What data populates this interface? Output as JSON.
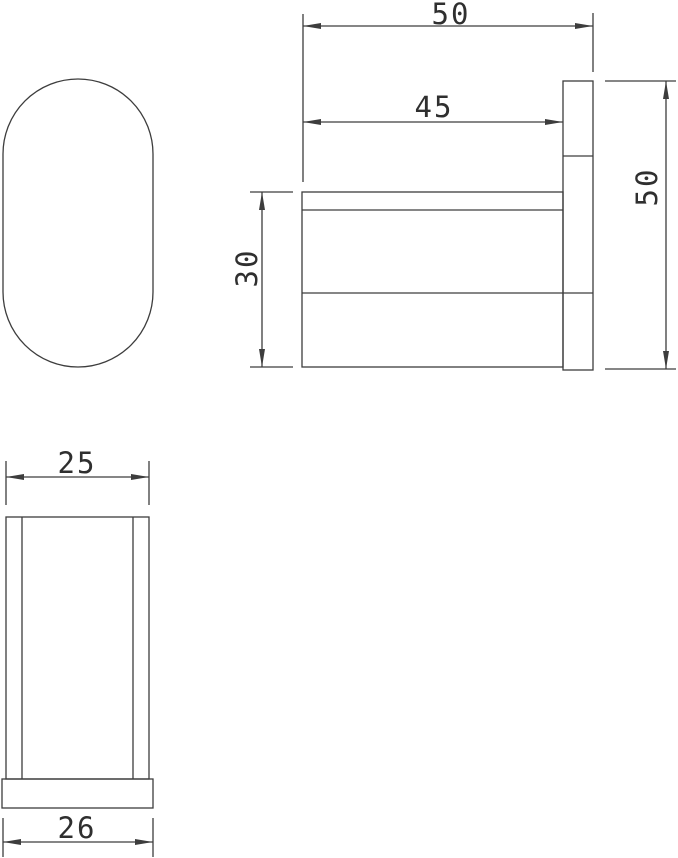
{
  "drawing": {
    "colors": {
      "line": "#3d3d3d",
      "text": "#2f2f2f",
      "background": "#ffffff"
    },
    "side_view": {
      "dim_total_depth": "50",
      "dim_hook_depth": "45",
      "dim_hook_height": "30",
      "dim_plate_height": "50"
    },
    "top_view": {
      "dim_body_width": "25",
      "dim_base_width": "26"
    }
  }
}
